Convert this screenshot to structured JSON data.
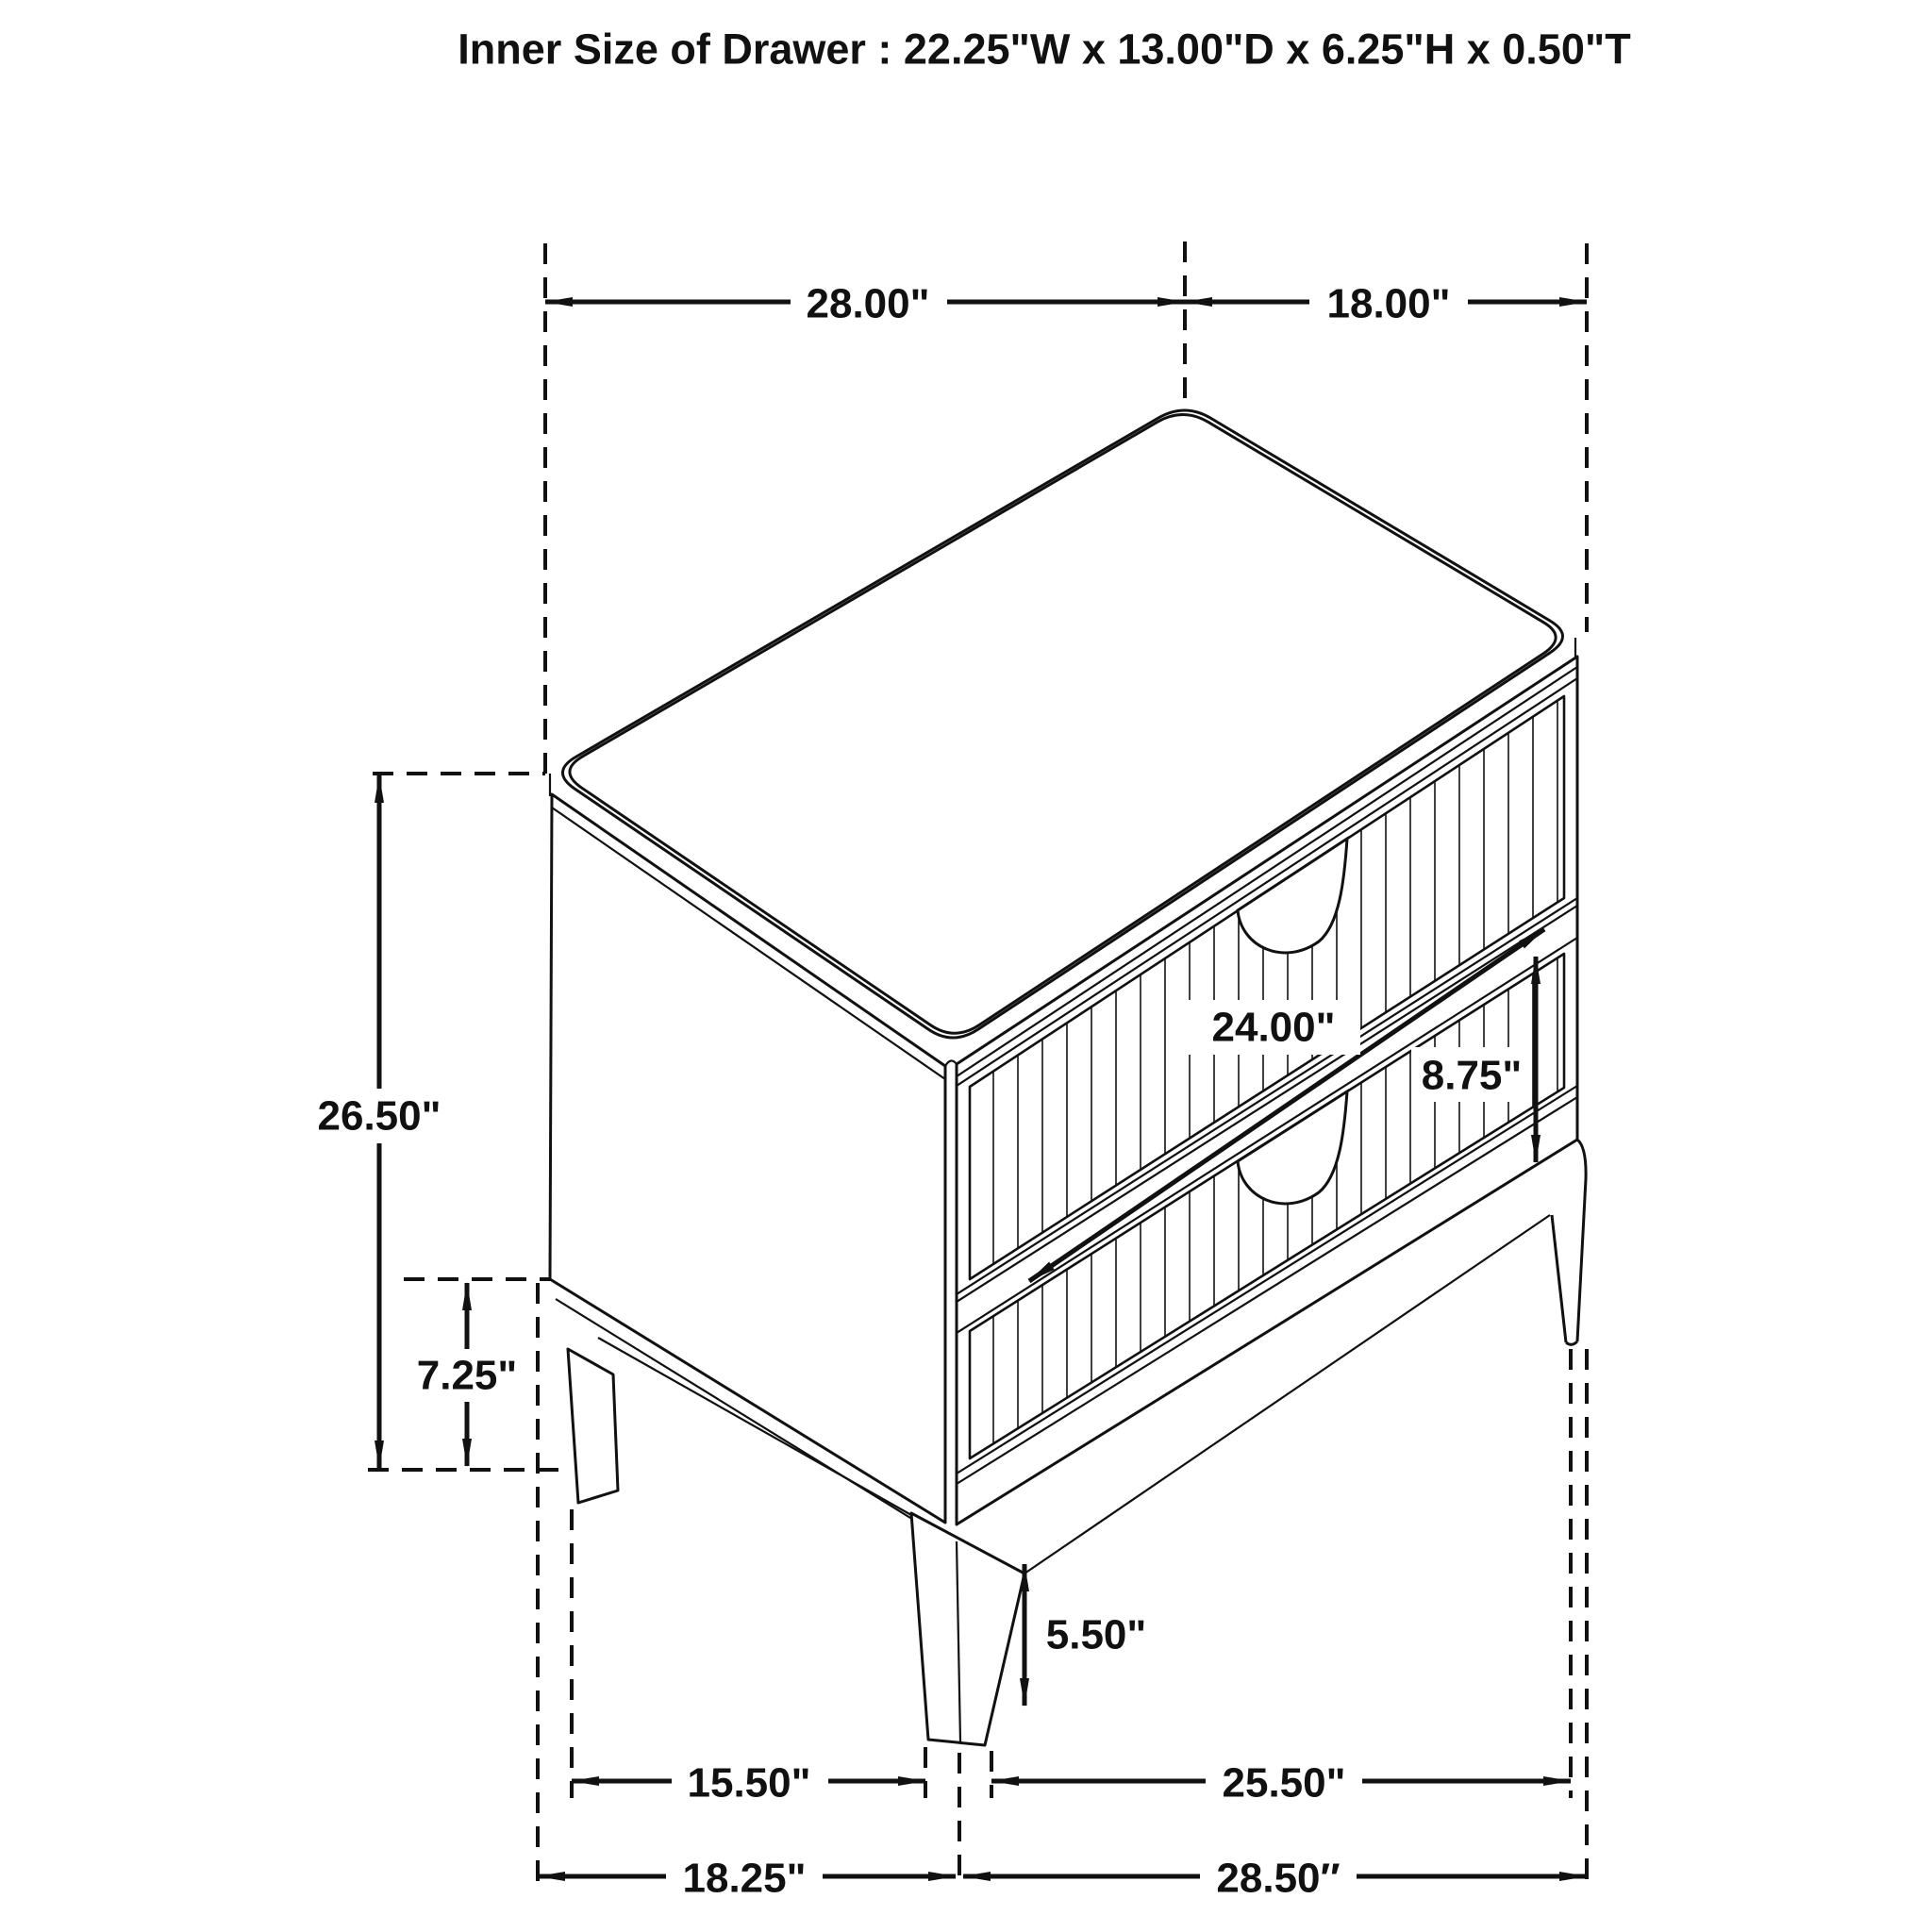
{
  "title": "Inner Size of Drawer : 22.25\"W x 13.00\"D x 6.25\"H x 0.50\"T",
  "dimensions": {
    "top_width": "28.00\"",
    "top_depth": "18.00\"",
    "overall_height": "26.50\"",
    "base_clearance": "7.25\"",
    "drawer_width": "24.00\"",
    "drawer_front_height": "8.75\"",
    "leg_height": "5.50\"",
    "feet_span_front_inner": "15.50\"",
    "feet_span_front_outer": "25.50\"",
    "footprint_depth": "18.25\"",
    "footprint_width": "28.50″"
  },
  "colors": {
    "line": "#111111",
    "background": "#ffffff"
  }
}
